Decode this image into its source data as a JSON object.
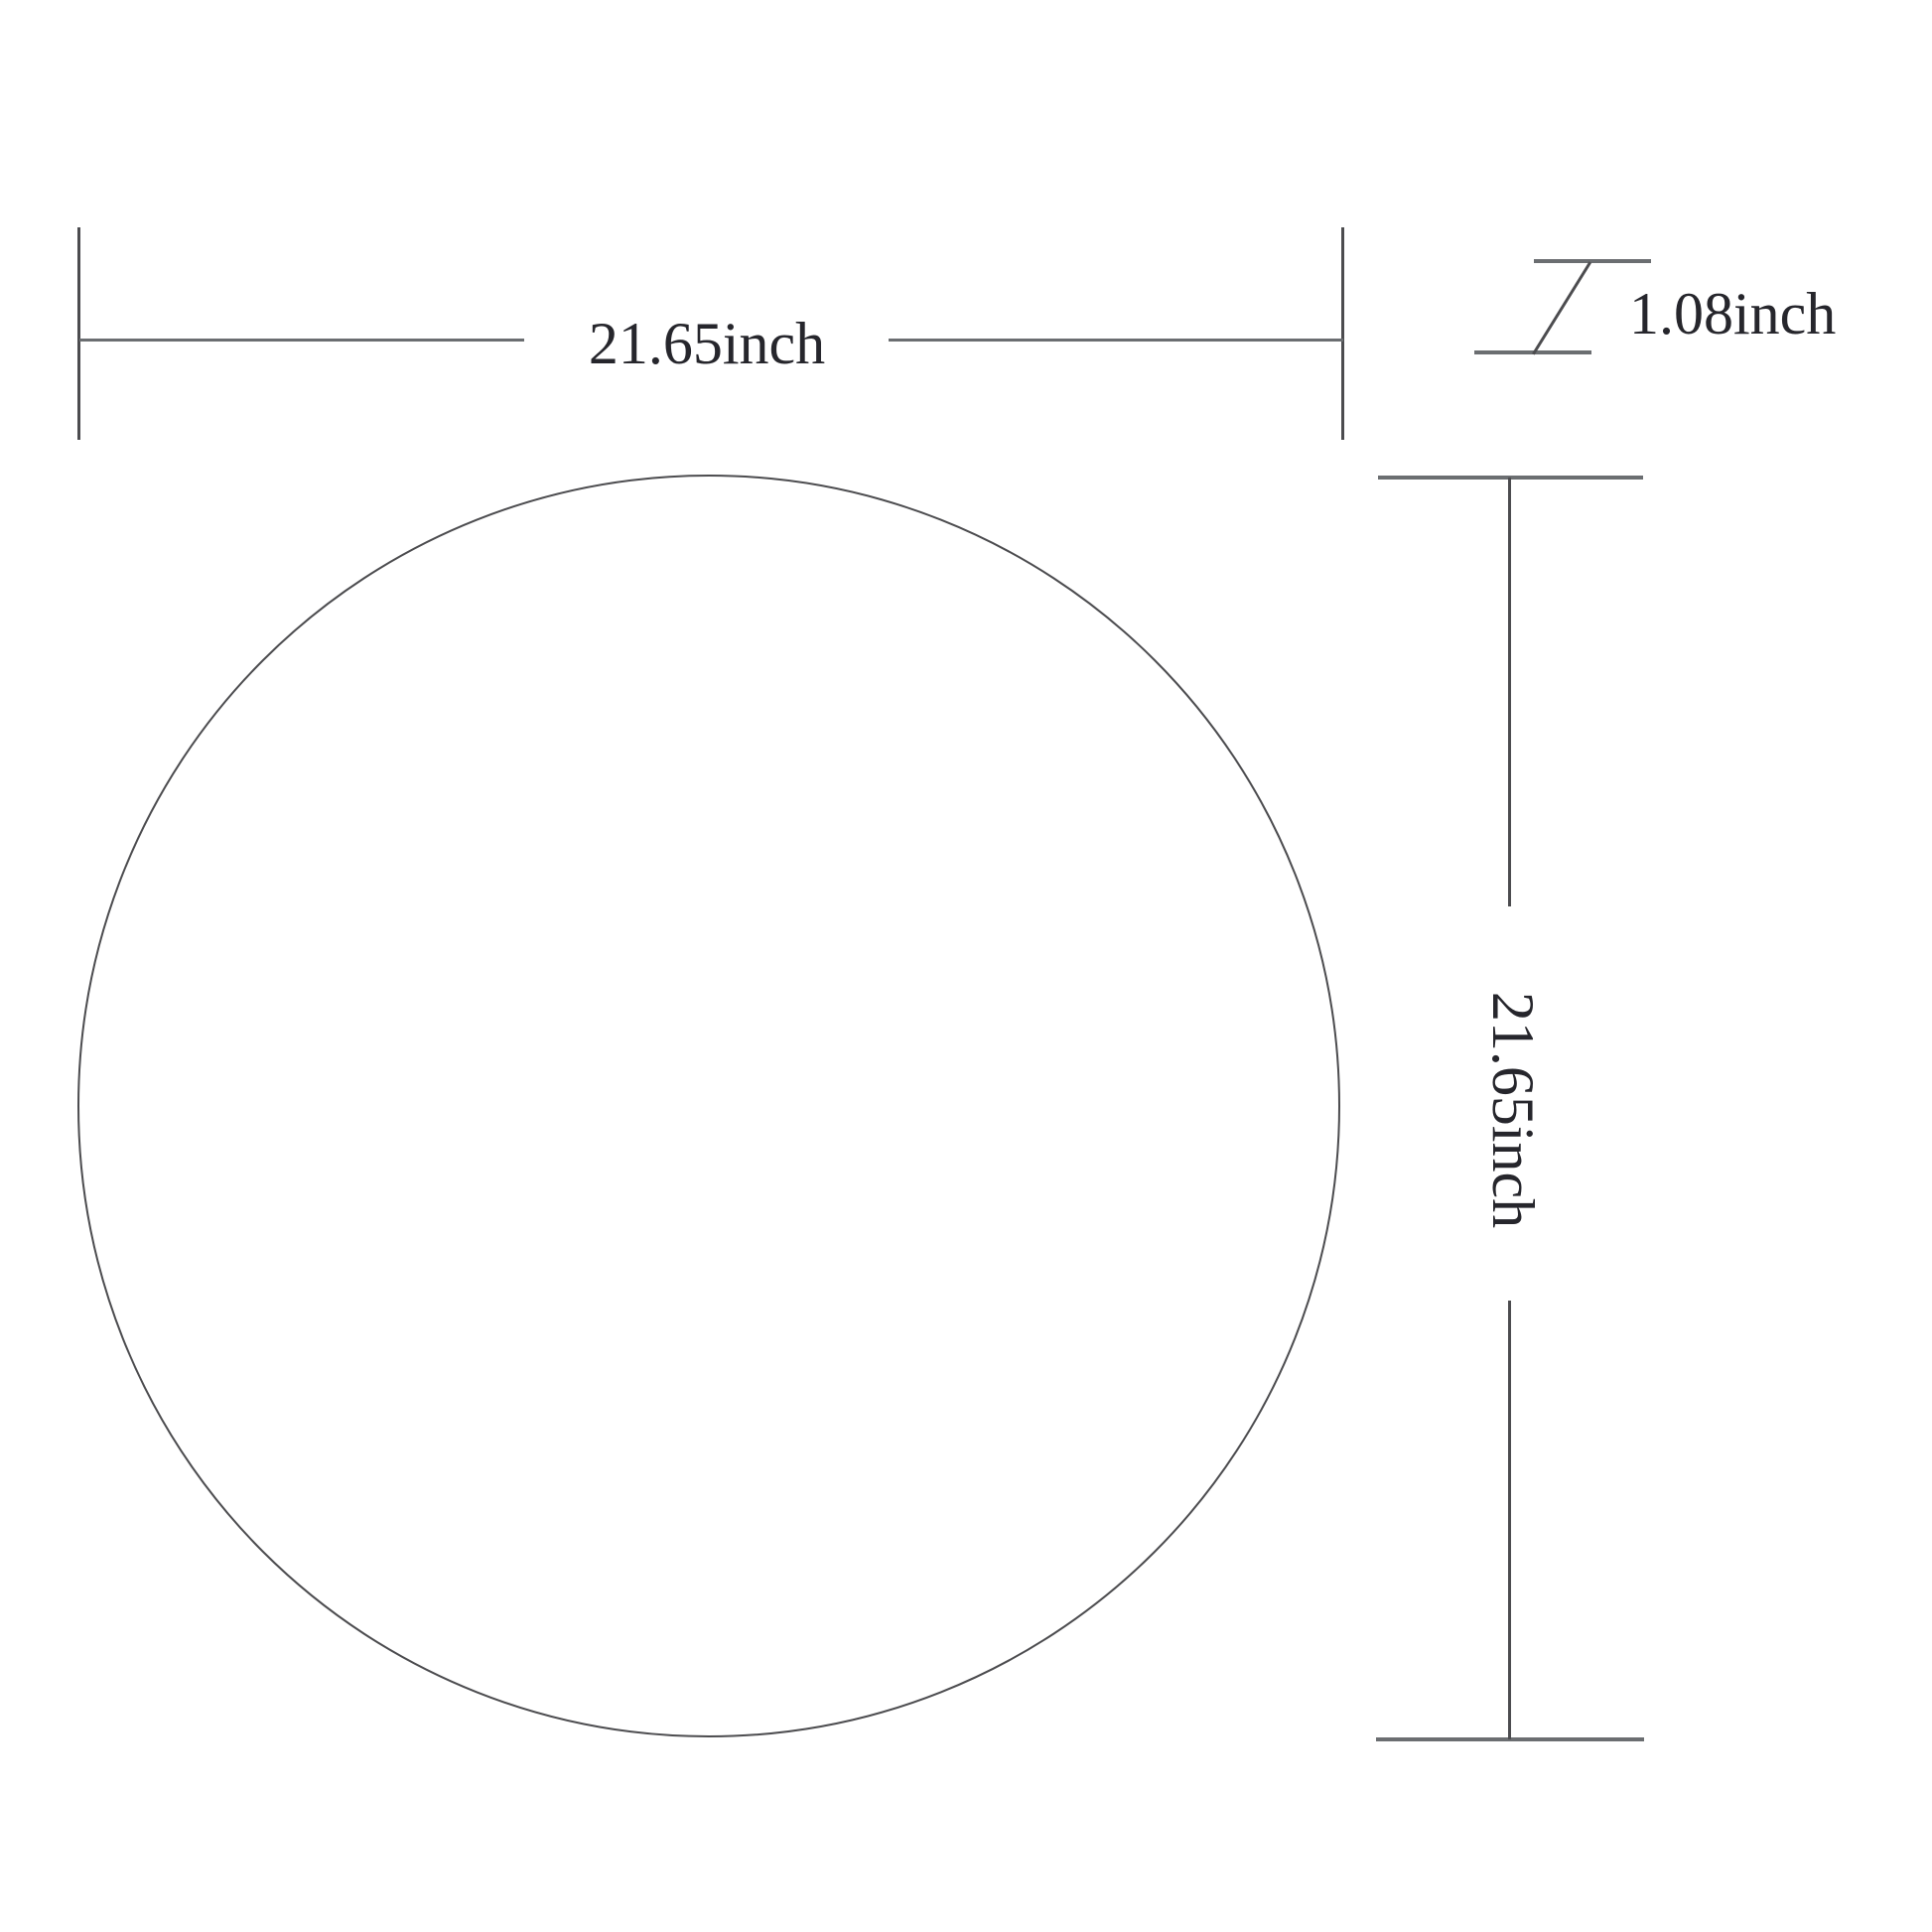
{
  "diagram": {
    "shape": "circle-outline",
    "dimensions": {
      "width": {
        "label": "21.65inch"
      },
      "height": {
        "label": "21.65inch"
      },
      "thickness": {
        "label": "1.08inch"
      }
    }
  },
  "colors": {
    "line-gray": "#6b6e71",
    "stroke-gray": "#4c4c4f",
    "text-color": "#26262c",
    "bg": "#ffffff"
  }
}
